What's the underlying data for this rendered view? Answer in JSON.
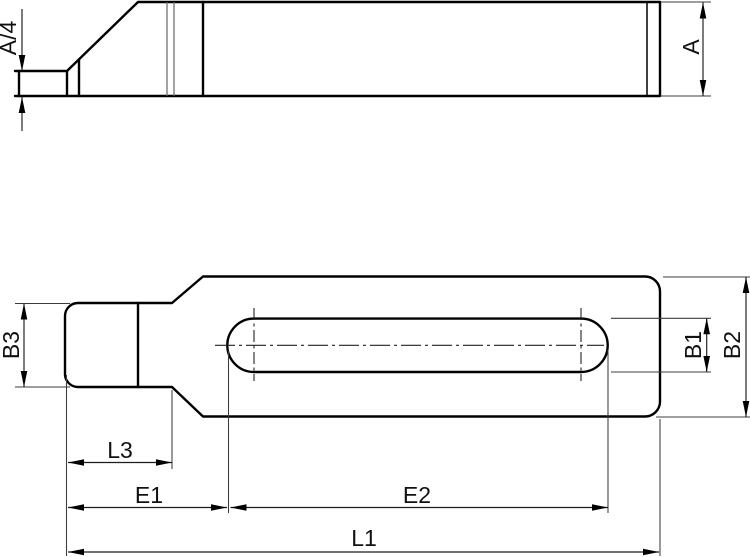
{
  "drawing": {
    "type": "technical-drawing",
    "background": "#ffffff",
    "line_color": "#000000",
    "views": {
      "side_view": "clamp strap side elevation with sloped nose",
      "top_view": "clamp strap plan view with elongated slot"
    }
  },
  "labels": {
    "a4": "A/4",
    "a": "A",
    "b3": "B3",
    "b1": "B1",
    "b2": "B2",
    "l3": "L3",
    "e1": "E1",
    "e2": "E2",
    "l1": "L1"
  }
}
